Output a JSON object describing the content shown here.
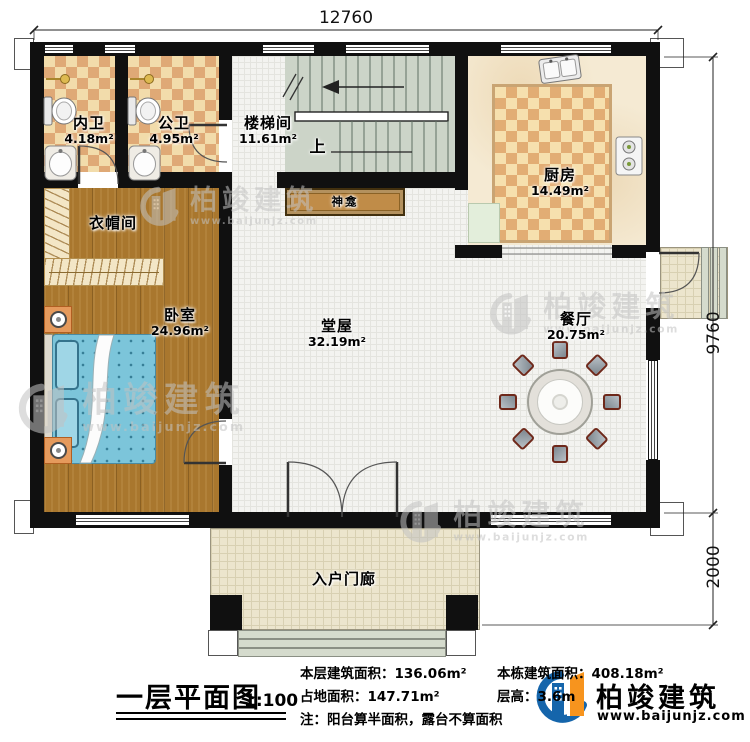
{
  "dimensions": {
    "top": "12760",
    "right_upper": "9760",
    "right_lower": "2000"
  },
  "rooms": {
    "neiwei": {
      "name": "内卫",
      "area": "4.18m²"
    },
    "gongwei": {
      "name": "公卫",
      "area": "4.95m²"
    },
    "loutijian": {
      "name": "楼梯间",
      "area": "11.61m²"
    },
    "chufang": {
      "name": "厨房",
      "area": "14.49m²"
    },
    "yimaojian": {
      "name": "衣帽间"
    },
    "woshi": {
      "name": "卧室",
      "area": "24.96m²"
    },
    "tangwu": {
      "name": "堂屋",
      "area": "32.19m²"
    },
    "canting": {
      "name": "餐厅",
      "area": "20.75m²"
    },
    "shenkan": {
      "name": "神龛"
    },
    "menlang": {
      "name": "入户门廊"
    }
  },
  "stairs": {
    "up": "上"
  },
  "plan": {
    "title": "一层平面图",
    "scale": "1:100"
  },
  "stats": {
    "floor_area_label": "本层建筑面积：",
    "floor_area": "136.06m²",
    "total_area_label": "本栋建筑面积：",
    "total_area": "408.18m²",
    "land_area_label": "占地面积：",
    "land_area": "147.71m²",
    "story_height_label": "层高：",
    "story_height": "3.6m",
    "note": "注：阳台算半面积，露台不算面积"
  },
  "branding": {
    "name": "柏竣建筑",
    "url": "www.baijunjz.com"
  },
  "watermark": {
    "name": "柏竣建筑",
    "url": "www.baijunjz.com"
  },
  "colors": {
    "wall": "#101010",
    "wood_floor": "#a9772e",
    "bath_tile_dark": "#dfa976",
    "bath_tile_light": "#f2dcab",
    "stair": "#ccd4c8",
    "bed": "#7cc5da",
    "logo_blue": "#1565ab",
    "logo_orange": "#f7941e",
    "watermark_gray": "#c2c2c2"
  }
}
